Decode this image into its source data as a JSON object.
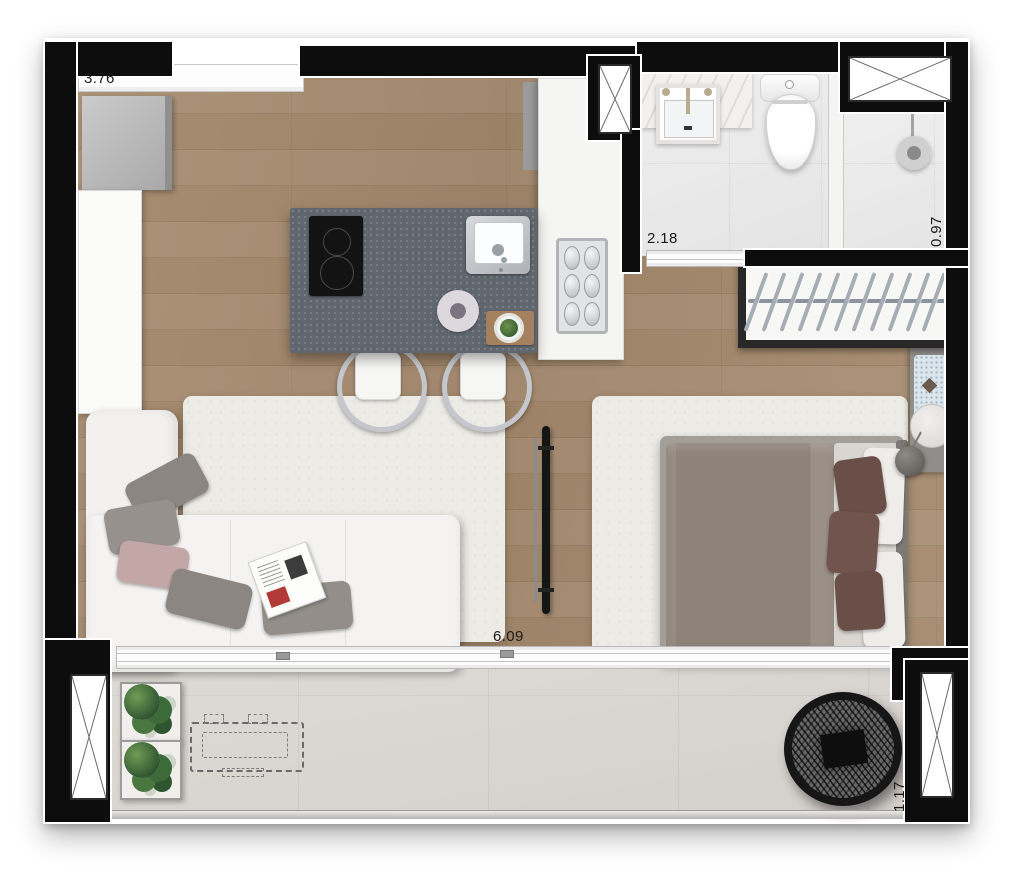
{
  "plan": {
    "dims": {
      "kitchen_width": "3.76",
      "bathroom_width": "2.18",
      "shower_width": "0.97",
      "living_width": "6.09",
      "balcony_depth": "1.17"
    },
    "colors": {
      "wall": "#0d0d0d",
      "wood_floor": "#a18768",
      "bath_tile": "#ececec",
      "balcony_tile": "#d9d5d1",
      "island_top": "#5f666e",
      "rug": "#edebe6",
      "sofa": "#f3f2f0",
      "duvet": "#8e8379",
      "pillow_brown": "#6a4e48",
      "plant_green": "#3c6a38"
    }
  }
}
